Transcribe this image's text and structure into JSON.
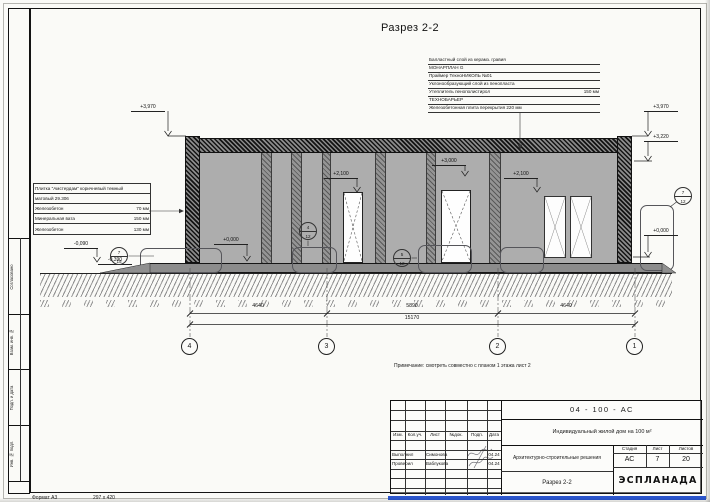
{
  "title": "Разрез 2-2",
  "note": "Примечание: смотреть совместно с планом 1 этажа лист 2",
  "roof_spec": {
    "rows": [
      {
        "text": "Балластный слой из керамз. гравия",
        "value": ""
      },
      {
        "text": "МОНАРПЛАН G",
        "value": ""
      },
      {
        "text": "Праймер ТехноНИКОЛЬ №01",
        "value": ""
      },
      {
        "text": "Уклонообразующий слой из пенопласта",
        "value": ""
      },
      {
        "text": "Утеплитель пенополистирол",
        "value": "150 мм"
      },
      {
        "text": "ТЕХНОБАРЬЕР",
        "value": ""
      },
      {
        "text": "Железобетонная плита перекрытия 220 мм",
        "value": ""
      }
    ]
  },
  "wall_spec": {
    "rows": [
      {
        "text": "Плитка \"Амстердам\" коричневый темный",
        "value": ""
      },
      {
        "text": "матовый 29.306",
        "value": ""
      },
      {
        "text": "Железобетон",
        "value": "70 мм"
      },
      {
        "text": "Минеральная вата",
        "value": "150 мм"
      },
      {
        "text": "Железобетон",
        "value": "130 мм"
      }
    ]
  },
  "elevations": [
    {
      "label": "+3,970"
    },
    {
      "label": "+3,970"
    },
    {
      "label": "+3,220"
    },
    {
      "label": "-0,090"
    },
    {
      "label": "-0,390"
    },
    {
      "label": "+0,000"
    },
    {
      "label": "+0,000"
    },
    {
      "label": "+2,100"
    },
    {
      "label": "+3,000"
    },
    {
      "label": "+2,100"
    }
  ],
  "dimensions": {
    "seg1": "4640",
    "seg2": "5890",
    "seg3": "4640",
    "total": "15170"
  },
  "axes": {
    "a4": "4",
    "a3": "3",
    "a2": "2",
    "a1": "1"
  },
  "callouts": [
    {
      "top": "7",
      "bottom": "15"
    },
    {
      "top": "4",
      "bottom": "12"
    },
    {
      "top": "5",
      "bottom": "12"
    },
    {
      "top": "7",
      "bottom": "12"
    }
  ],
  "stamp": {
    "doc_number": "04 - 100 - АС",
    "project": "Индивидуальный жилой дом на 100 м²",
    "section": "Архитектурно-строительные решения",
    "sheet_title": "Разрез 2-2",
    "col_izm": "Изм.",
    "col_kol": "Кол.уч.",
    "col_list": "Лист",
    "col_doc": "№док.",
    "col_podp": "Подп.",
    "col_data": "Дата",
    "row1_role": "Выполнил",
    "row1_name": "Симонова",
    "row1_date": "04.24",
    "row2_role": "Проверил",
    "row2_name": "Ваблукова",
    "row2_date": "04.24",
    "stage_label": "Стадия",
    "sheet_label": "Лист",
    "sheets_label": "Листов",
    "stage": "АС",
    "sheet": "7",
    "sheets": "20",
    "logo": "ЭСПЛАНАДА"
  },
  "side_strip": {
    "s1": "Согласовано",
    "s2": "Взам. инв. №",
    "s3": "Подп. и дата",
    "s4": "Инв. № подл."
  },
  "footer": {
    "format": "Формат А3",
    "size": "297 х 420"
  }
}
